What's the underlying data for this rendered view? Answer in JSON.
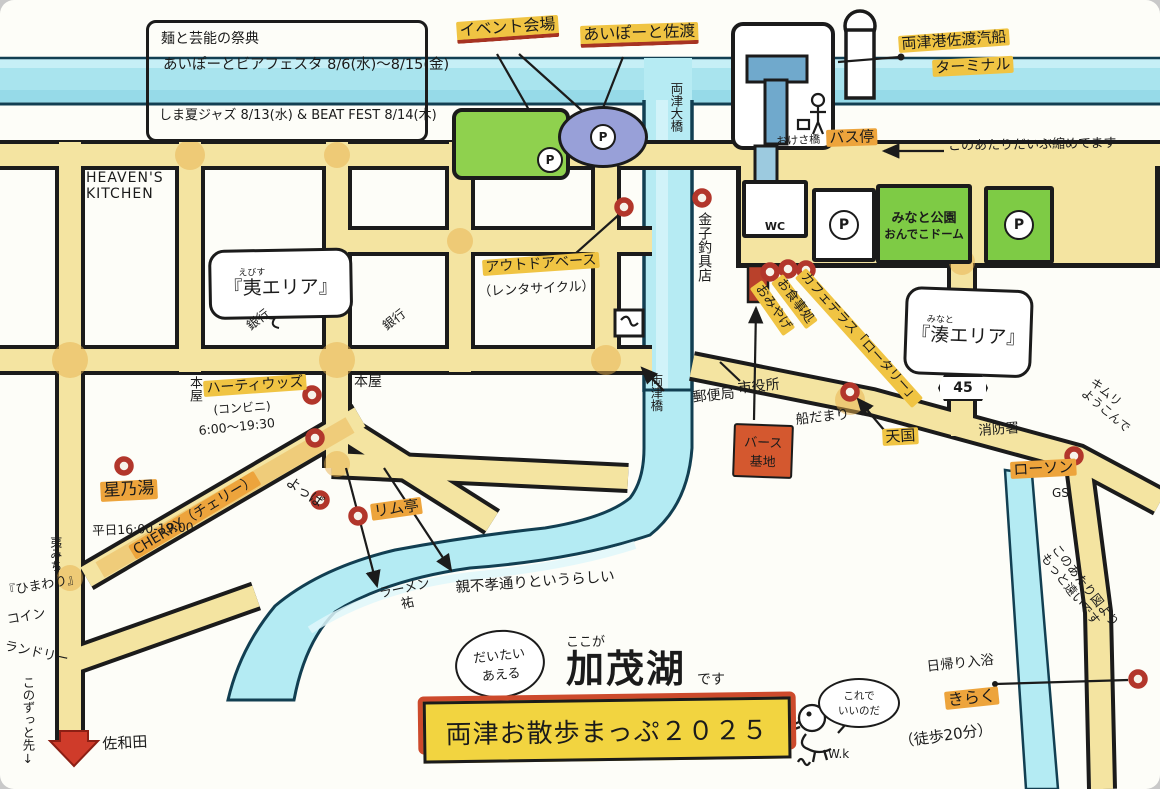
{
  "colors": {
    "road_fill": "#f4e4a1",
    "ink": "#1b1b1b",
    "water": "#aee6ef",
    "lake": "#b4ebf3",
    "highlight_yellow": "#f0c443",
    "highlight_orange": "#eda43c",
    "marker_red": "#b2362b",
    "park_green": "#7ecb45",
    "event_green": "#8fd14e",
    "ellipse_purple": "#98a0d8",
    "banner_red": "#cd4a2c",
    "banner_yellow": "#f2d440",
    "berth_red": "#d4582f"
  },
  "info_box": {
    "line1": "麺と芸能の祭典",
    "line2": "あいぽーとビアフェスタ 8/6(水)〜8/15(金)",
    "line3": "しま夏ジャズ 8/13(水) & BEAT FEST 8/14(木)"
  },
  "top": {
    "event_venue": "イベント会場",
    "aiport": "あいぽーと佐渡",
    "terminal1": "両津港佐渡汽船",
    "terminal2": "ターミナル",
    "bus_stop": "バス停",
    "note_compressed": "このあたりだいぶ縮めてます",
    "okesa_bridge": "おけさ橋",
    "ohashi": "両津大橋"
  },
  "port": {
    "wc": "WC",
    "p": "P",
    "park1": "みなと公園",
    "park2": "おんでこドーム"
  },
  "west": {
    "heavens1": "HEAVEN'S",
    "heavens2": "KITCHEN",
    "ebisu_open": "『",
    "ebisu_kanji": "夷",
    "ebisu_furi": "えびす",
    "ebisu_rest": "エリア』",
    "bank": "銀行",
    "bookstore": "本屋",
    "hearty": "ハーティウッズ",
    "hearty_type": "(コンビニ)",
    "hearty_hours": "6:00〜19:30",
    "cherry": "CHERRY（チェリー）",
    "yoppa": "よっぱ",
    "hoshinoyu": "星乃湯",
    "hoshinoyu_hours": "平日16:00-19:00",
    "michi": "夷みち",
    "himawari1": "『ひまわり』",
    "himawari2": "コイン",
    "himawari3": "ランドリー",
    "himawari4": "このずっと先↓",
    "sawada": "佐和田"
  },
  "center": {
    "outdoor": "アウトドアベース",
    "rental": "（レンタサイクル）",
    "kaneko": "金子釣具店",
    "bashi": "両津橋",
    "post": "郵便局",
    "cityhall": "市役所",
    "funadamari": "船だまり",
    "berth1": "バース",
    "berth2": "基地",
    "ramutei": "リム亭",
    "ramen1": "ラーメン",
    "ramen2": "祐",
    "oyafuko": "親不孝通りというらしい"
  },
  "east": {
    "omiyage": "おみやげ",
    "oshokuji": "お食事処",
    "cafe": "カフェテラス「ロータリー」",
    "minato_open": "『",
    "minato_kanji": "湊",
    "minato_furi": "みなと",
    "minato_rest": "エリア』",
    "route45": "45",
    "fire": "消防署",
    "tengoku": "天国",
    "lawson": "ローソン",
    "gs": "GS",
    "kimuri1": "キムリ",
    "kimuri2": "ようこんで",
    "far_note": "このあたり図よりもっと遠いです"
  },
  "south": {
    "daitai1": "だいたい",
    "daitai2": "あえる",
    "kokoga": "ここが",
    "kamoko": "加茂湖",
    "desu": "です",
    "title": "両津お散歩まっぷ２０２５",
    "bubble1": "これで",
    "bubble2": "いいのだ",
    "signature": "W.k",
    "higaeri": "日帰り入浴",
    "kiraku": "きらく",
    "walk": "（徒歩20分）"
  }
}
